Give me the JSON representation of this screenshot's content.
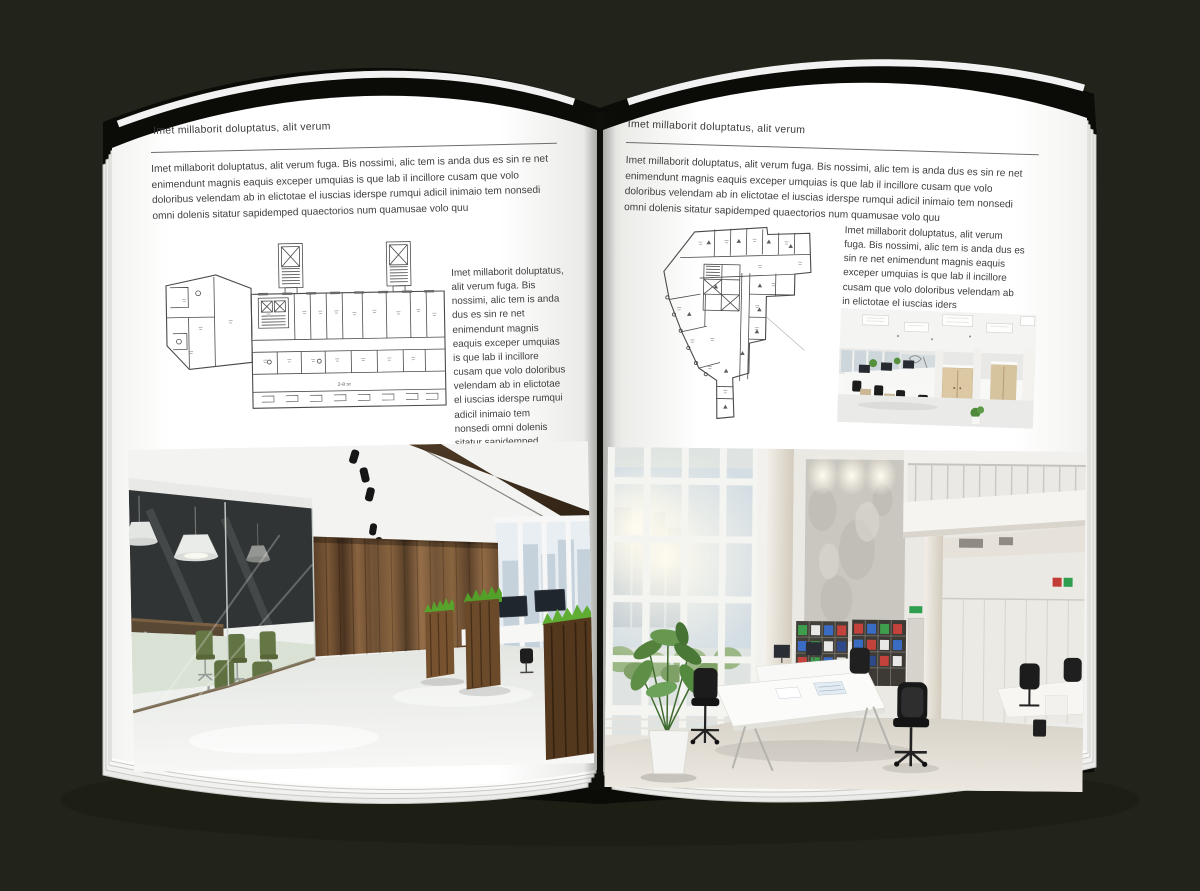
{
  "palette": {
    "background": "#22231a",
    "cover": "#0b0b08",
    "page": "#ffffff",
    "rule": "#6e6e6e",
    "plan_ink": "#4a4a4a"
  },
  "left_page": {
    "header": "Imet millaborit doluptatus, alit verum",
    "intro": "Imet millaborit doluptatus, alit verum fuga. Bis nossimi, alic tem is anda dus es sin re net enimendunt magnis eaquis exceper umquias is que lab il incillore cusam que volo doloribus velendam ab in elictotae el iuscias iderspe rumqui adicil inimaio tem nonsedi omni dolenis sitatur sapidemped quaectorios num quamusae volo quu",
    "side_text": "Imet millaborit doluptatus, alit verum fuga. Bis nossimi, alic tem is anda dus es sin re net enimendunt magnis eaquis exceper umquias is que lab il incillore cusam que volo doloribus velendam ab in elictotae el iuscias iderspe rumqui adicil inimaio tem nonsedi omni dolenis sitatur sapidemped quaectorios num quamusae volo quu",
    "plan_label": "2-й эт"
  },
  "right_page": {
    "header": "Imet millaborit doluptatus, alit verum",
    "intro": "Imet millaborit doluptatus, alit verum fuga. Bis nossimi, alic tem is anda dus es sin re net enimendunt magnis eaquis exceper umquias is que lab il incillore cusam que volo doloribus velendam ab in elictotae el iuscias iderspe rumqui adicil inimaio tem nonsedi omni dolenis sitatur sapidemped quaectorios num quamusae volo quu",
    "side_text": "Imet millaborit doluptatus, alit verum fuga. Bis nossimi, alic tem is anda dus es sin re net enimendunt magnis eaquis exceper umquias is que lab il incillore cusam que volo doloribus velendam ab in elictotae el iuscias iders"
  }
}
